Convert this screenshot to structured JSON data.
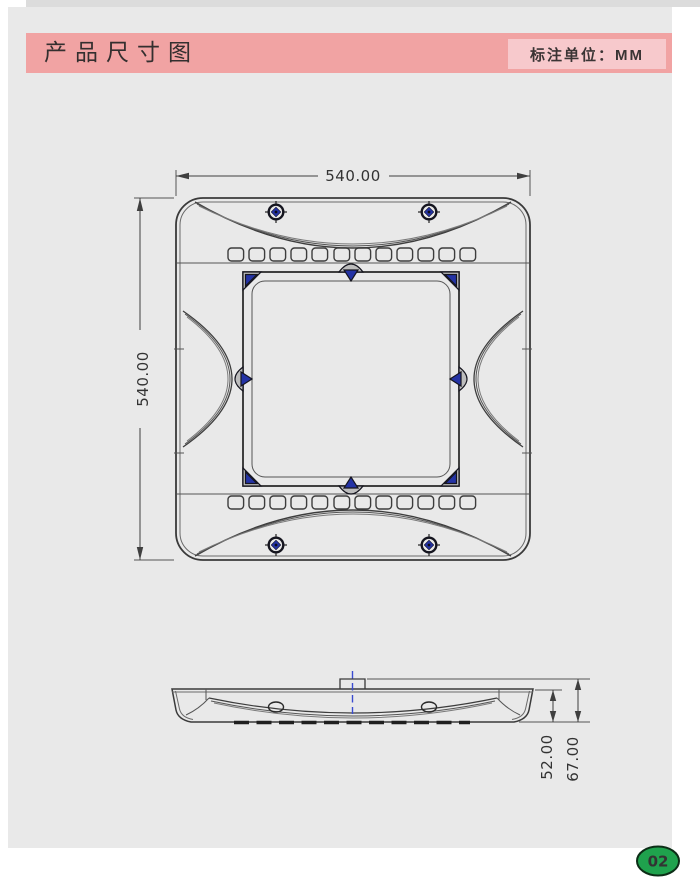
{
  "header": {
    "title": "产品尺寸图",
    "unit_label": "标注单位：MM"
  },
  "drawing": {
    "top_view": {
      "width_dim": "540.00",
      "height_dim": "540.00"
    },
    "side_view": {
      "body_height_dim": "52.00",
      "overall_height_dim": "67.00"
    }
  },
  "page_badge": "02",
  "colors": {
    "header_bar": "#f1a3a3",
    "unit_box": "#f7c9cc",
    "canvas_gray": "#e9e9e9",
    "drawing_line": "#3f3f3f",
    "accent_blue": "#2433a5",
    "badge_green": "#1fa24d"
  }
}
